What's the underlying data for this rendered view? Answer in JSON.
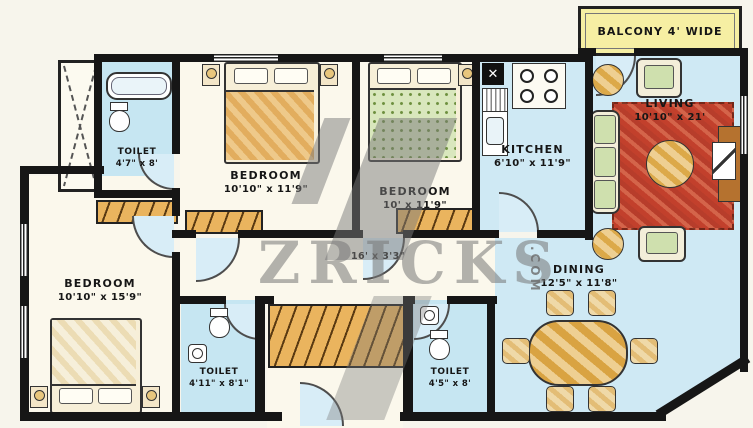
{
  "rooms": {
    "balcony": {
      "label": "BALCONY 4' WIDE"
    },
    "living": {
      "name": "LIVING",
      "dims": "10'10\" x 21'"
    },
    "kitchen": {
      "name": "KITCHEN",
      "dims": "6'10\" x 11'9\""
    },
    "bedroom_top_left": {
      "name": "BEDROOM",
      "dims": "10'10\" x 11'9\""
    },
    "bedroom_top_center": {
      "name": "BEDROOM",
      "dims": "10' x 11'9\""
    },
    "bedroom_bottom_left": {
      "name": "BEDROOM",
      "dims": "10'10\" x 15'9\""
    },
    "toilet_top_left": {
      "name": "TOILET",
      "dims": "4'7\" x 8'"
    },
    "toilet_bottom_left": {
      "name": "TOILET",
      "dims": "4'11\" x 8'1\""
    },
    "toilet_bottom_center": {
      "name": "TOILET",
      "dims": "4'5\" x 8'"
    },
    "dining": {
      "name": "DINING",
      "dims": "12'5\" x 11'8\""
    },
    "passage": {
      "dims": "16' x 3'3\""
    }
  },
  "watermark": {
    "text": "ZRICKS",
    "tld": ".COM"
  },
  "colors": {
    "wall": "#161616",
    "floor_blue": "#cfe9f4",
    "floor_cream": "#fbf8ec",
    "toilet_blue": "#c6e6f2",
    "balcony_yellow": "#f6efa3",
    "carpet_red": "#c54a34",
    "wood_orange": "#e2a24e",
    "watermark_gray": "#7a7a7a"
  }
}
